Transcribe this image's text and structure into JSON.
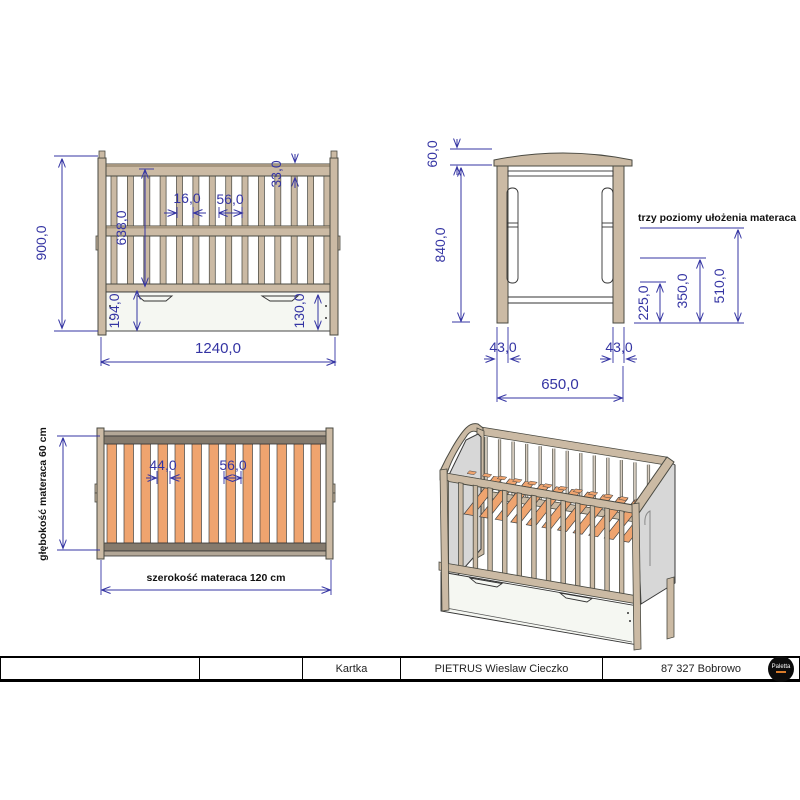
{
  "front_view": {
    "dims": {
      "total_height": "900,0",
      "inner_height": "638,0",
      "base_height": "194,0",
      "slat_width": "16,0",
      "slat_spacing": "56,0",
      "rail_thickness": "33,0",
      "drawer_front_height": "130,0",
      "total_width": "1240,0"
    }
  },
  "side_view": {
    "dims": {
      "arch_height": "60,0",
      "side_height": "840,0",
      "left_leg_width": "43,0",
      "right_leg_width": "43,0",
      "total_depth": "650,0",
      "mattress_level_low": "225,0",
      "mattress_level_mid": "350,0",
      "mattress_level_high": "510,0"
    },
    "note": "trzy poziomy ułożenia materaca"
  },
  "base_view": {
    "dims": {
      "slat_width": "44,0",
      "slat_spacing": "56,0"
    },
    "depth_label": "głębokość materaca 60 cm",
    "width_label": "szerokość materaca 120 cm"
  },
  "title_block": {
    "cell_1": "",
    "cell_2": "",
    "sheet_label": "Kartka",
    "author": "PIETRUS Wieslaw Cieczko",
    "location": "87 327 Bobrowo",
    "logo_text": "Paletta"
  },
  "colors": {
    "dimension_blue": "#3434a3",
    "wood_tan": "#cbbaa4",
    "slat_orange": "#efa46f",
    "panel_gray": "#d7d7d7",
    "dark_rail": "#847a6d",
    "drawer_white": "#f5f7f2"
  }
}
